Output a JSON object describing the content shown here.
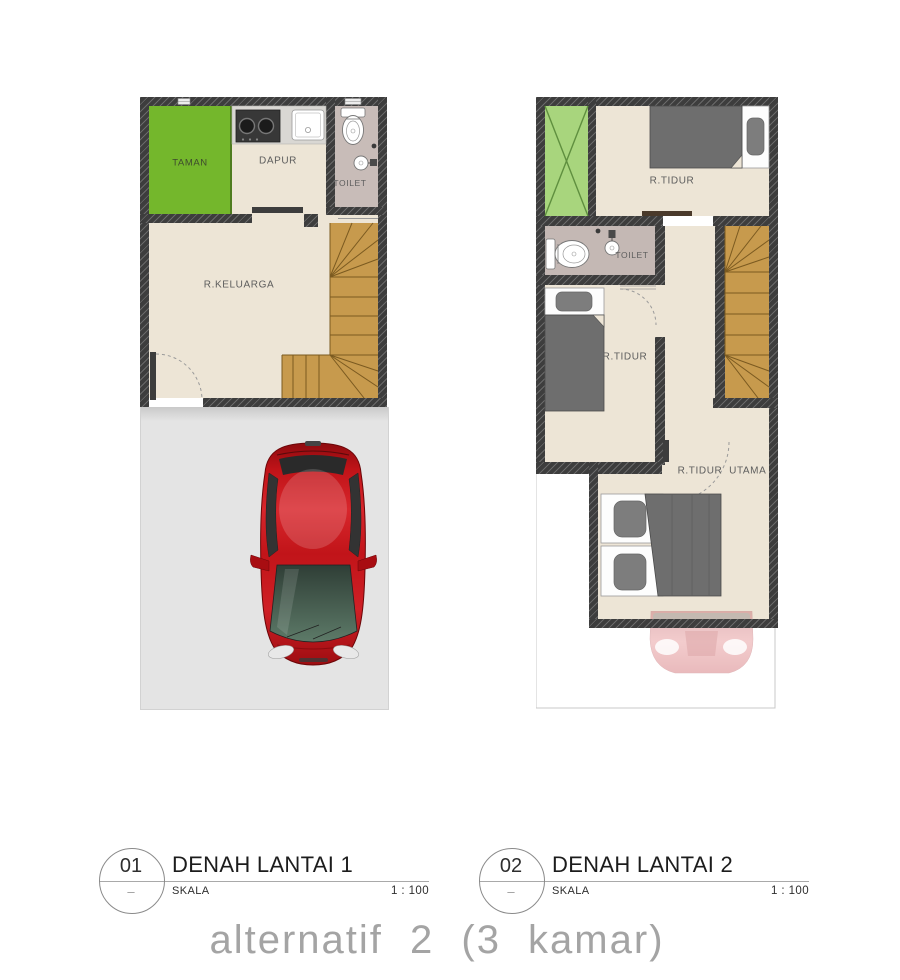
{
  "floor1": {
    "labels": {
      "taman": "TAMAN",
      "dapur": "DAPUR",
      "toilet": "TOILET",
      "keluarga": "R.KELUARGA"
    }
  },
  "floor2": {
    "labels": {
      "tidur1": "R.TIDUR",
      "toilet": "TOILET",
      "tidur2": "R.TIDUR",
      "utama": "R.TIDUR  UTAMA"
    }
  },
  "captions": [
    {
      "number": "01",
      "dash": "–",
      "title": "DENAH LANTAI 1",
      "scale_label": "SKALA",
      "scale_value": "1 : 100"
    },
    {
      "number": "02",
      "dash": "–",
      "title": "DENAH LANTAI 2",
      "scale_label": "SKALA",
      "scale_value": "1 : 100"
    }
  ],
  "footer": {
    "title": "alternatif 2 (3 kamar)"
  },
  "colors": {
    "wall": "#3d3d3d",
    "room_floor": "#ede5d6",
    "taman_green": "#74b72c",
    "void_green": "#a8d57d",
    "toilet_floor": "#c8bcb8",
    "stairs_wood": "#c79a4d",
    "carport_gray": "#e4e4e4",
    "car_red": "#c01318",
    "bed_blanket_gray": "#6e6e6e"
  }
}
